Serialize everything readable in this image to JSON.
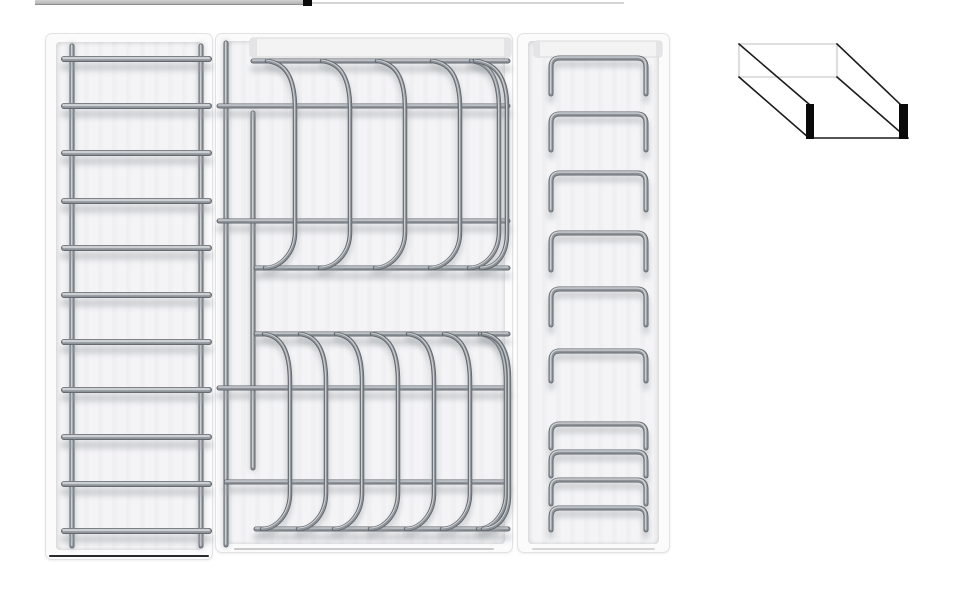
{
  "meta": {
    "description": "Product render: three white kitchen-drawer organizer inserts with grey metal wire racks, plus an oblique line sketch of an open drawer box; a thin cropped element sliver sits at the top edge.",
    "canvas": {
      "w": 973,
      "h": 600
    },
    "background": "#ffffff"
  },
  "colors": {
    "tray_face": "#fbfbfc",
    "tray_border": "#e2e2e5",
    "tray_inner": "#f4f4f6",
    "rail_face": "#f3f3f4",
    "rail_border": "#d8d8da",
    "rail_cap": "#e4e4e6",
    "wire_dark": "#5f656b",
    "wire_mid": "#8d9399",
    "wire_light": "#ccd0d3",
    "wire_shadow": "#9aa0a5",
    "ladder_bottom_edge": "#2a2a2c",
    "mid_bottom_edge": "#c9c9cb",
    "right_bottom_edge": "#d5d5d7",
    "sketch_solid": "#1c1c1c",
    "sketch_hidden": "#cccccc",
    "sketch_bar": "#0a0a0a",
    "crop_bar_top": "#d2d2d2",
    "crop_bar_bottom": "#b3b3b3",
    "crop_bar_edge": "#8e8e8e",
    "crop_mark": "#0b0b0b",
    "crop_line": "#d4d4d4"
  },
  "top_crop": {
    "bar": {
      "x": 35,
      "y": 0,
      "w": 268,
      "h": 4
    },
    "mark": {
      "x": 303,
      "y": 0,
      "w": 9,
      "h": 6
    },
    "line": {
      "x": 312,
      "y": 2,
      "w": 312,
      "h": 2
    }
  },
  "panels": {
    "ladder": {
      "x": 45,
      "y": 33,
      "w": 168,
      "h": 527,
      "inner": {
        "l": 10,
        "t": 8,
        "r": 10,
        "b": 9
      },
      "rails_x": [
        26,
        155
      ],
      "rail_y1": 12,
      "rail_y2": 512,
      "rail_w": 5,
      "rung_x1": 18,
      "rung_x2": 163,
      "rung_w": 6,
      "rungs_y": [
        25,
        72,
        119,
        167,
        214,
        261,
        308,
        356,
        403,
        450,
        497
      ],
      "bottom_edge": {
        "l": 3,
        "r": 3,
        "b": 2,
        "h": 2
      }
    },
    "plates": {
      "x": 215,
      "y": 33,
      "w": 298,
      "h": 520,
      "inner": {
        "l": 11,
        "t": 7,
        "r": 7,
        "b": 8
      },
      "top_rail": {
        "x": 34,
        "y": 4,
        "w": 261,
        "h": 19,
        "cap_w": 7
      },
      "bars": [
        {
          "y": 27,
          "x1": 37,
          "x2": 292
        },
        {
          "y": 72,
          "x1": 3,
          "x2": 292
        },
        {
          "y": 187,
          "x1": 3,
          "x2": 292
        },
        {
          "y": 234,
          "x1": 40,
          "x2": 292
        },
        {
          "y": 300,
          "x1": 40,
          "x2": 292
        },
        {
          "y": 354,
          "x1": 3,
          "x2": 292
        },
        {
          "y": 448,
          "x1": 10,
          "x2": 292
        },
        {
          "y": 495,
          "x1": 40,
          "x2": 292
        }
      ],
      "bar_w": 5,
      "vertical_wires": [
        {
          "x": 10,
          "y1": 9,
          "y2": 511
        },
        {
          "x": 37,
          "y1": 79,
          "y2": 434
        }
      ],
      "sections": [
        {
          "t": 27,
          "b": 234,
          "dx": 28,
          "xs": [
            51,
            106,
            161,
            216,
            255
          ],
          "edge_x": 259,
          "edge_dx": 32
        },
        {
          "t": 300,
          "b": 495,
          "dx": 26,
          "xs": [
            48,
            84,
            120,
            156,
            192,
            228,
            264
          ],
          "edge_x": 267,
          "edge_dx": 26
        }
      ],
      "divider_w": 4.5,
      "bottom_edge": {
        "l": 18,
        "r": 18,
        "b": 2,
        "h": 2
      }
    },
    "lids": {
      "x": 517,
      "y": 33,
      "w": 153,
      "h": 520,
      "inner": {
        "l": 10,
        "t": 7,
        "r": 10,
        "b": 8
      },
      "top_rail": {
        "x": 16,
        "y": 7,
        "w": 128,
        "h": 16,
        "cap_w": 6
      },
      "bracket_x1": 33,
      "bracket_x2": 128,
      "bracket_r": 9,
      "bracket_w": 5,
      "brackets": [
        {
          "y": 24,
          "leg": 36
        },
        {
          "y": 80,
          "leg": 36
        },
        {
          "y": 139,
          "leg": 37
        },
        {
          "y": 199,
          "leg": 37
        },
        {
          "y": 255,
          "leg": 36
        },
        {
          "y": 317,
          "leg": 30
        },
        {
          "y": 390,
          "leg": 24
        },
        {
          "y": 418,
          "leg": 24
        },
        {
          "y": 446,
          "leg": 24
        },
        {
          "y": 474,
          "leg": 22
        }
      ],
      "bottom_edge": {
        "l": 14,
        "r": 14,
        "b": 2,
        "h": 2
      }
    }
  },
  "sketch": {
    "x": 735,
    "y": 40,
    "w": 185,
    "h": 108,
    "hidden_lines": [
      [
        4,
        4,
        102,
        4
      ],
      [
        4,
        4,
        4,
        37
      ],
      [
        102,
        4,
        102,
        37
      ],
      [
        4,
        37,
        102,
        37
      ]
    ],
    "solid_lines": [
      [
        4,
        4,
        75,
        65
      ],
      [
        4,
        37,
        74,
        98
      ],
      [
        102,
        4,
        166,
        65
      ],
      [
        102,
        37,
        172,
        98
      ],
      [
        75,
        98,
        173,
        98
      ]
    ],
    "bars": [
      {
        "x": 71,
        "y": 64,
        "w": 8,
        "h": 35
      },
      {
        "x": 164,
        "y": 64,
        "w": 9,
        "h": 35
      }
    ],
    "solid_width": 1.6,
    "hidden_width": 1.3
  }
}
